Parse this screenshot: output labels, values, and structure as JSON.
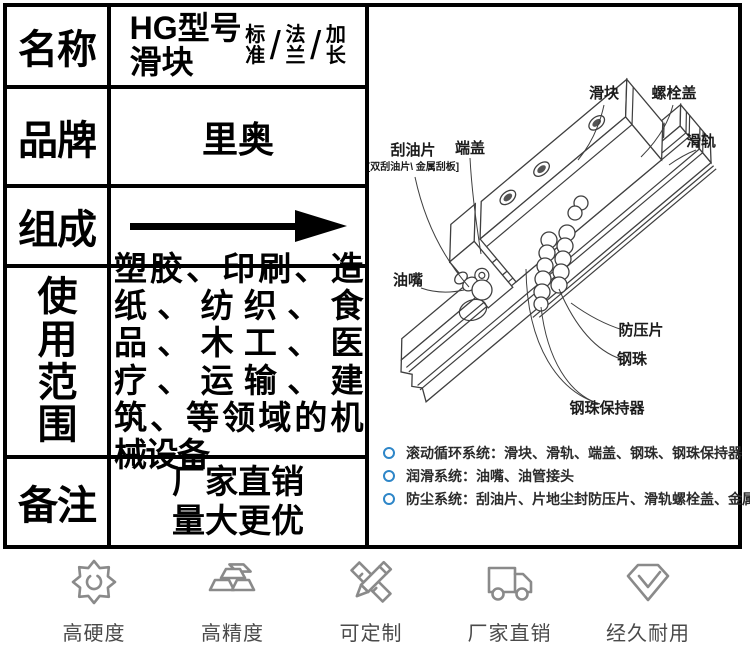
{
  "table": {
    "name": {
      "label": "名称",
      "model": "HG型号\n滑块",
      "variants": [
        "标准",
        "法兰",
        "加长"
      ],
      "slash": "/"
    },
    "brand": {
      "label": "品牌",
      "value": "里奥"
    },
    "composition": {
      "label": "组成"
    },
    "usage": {
      "label": "使用范围",
      "value": "塑胶、印刷、造纸、纺织、食品、木工、医疗、运输、建筑、等领域的机械设备"
    },
    "remark": {
      "label": "备注",
      "line1": "厂家直销",
      "line2": "量大更优"
    }
  },
  "diagram": {
    "callouts": {
      "slider": "滑块",
      "bolt_cover": "螺栓盖",
      "rail": "滑轨",
      "oil_scraper": "刮油片",
      "oil_scraper_note": "[双刮油片\\ 金属刮板]",
      "end_cap": "端盖",
      "oil_nipple": "油嘴",
      "anti_press_plate": "防压片",
      "steel_ball": "钢珠",
      "ball_retainer": "钢珠保持器"
    },
    "bullets": [
      "滚动循环系统：滑块、滑轨、端盖、钢珠、钢珠保持器",
      "润滑系统：油嘴、油管接头",
      "防尘系统：刮油片、片地尘封防压片、滑轨螺栓盖、金属刮板"
    ]
  },
  "footer": {
    "features": [
      {
        "icon": "gear-icon",
        "label": "高硬度"
      },
      {
        "icon": "ingots-icon",
        "label": "高精度"
      },
      {
        "icon": "pencil-ruler-icon",
        "label": "可定制"
      },
      {
        "icon": "truck-icon",
        "label": "厂家直销"
      },
      {
        "icon": "diamond-check-icon",
        "label": "经久耐用"
      }
    ]
  },
  "colors": {
    "bullet_blue": "#2e86c8",
    "icon_gray": "#8a8a8a",
    "table_border": "#000000"
  }
}
